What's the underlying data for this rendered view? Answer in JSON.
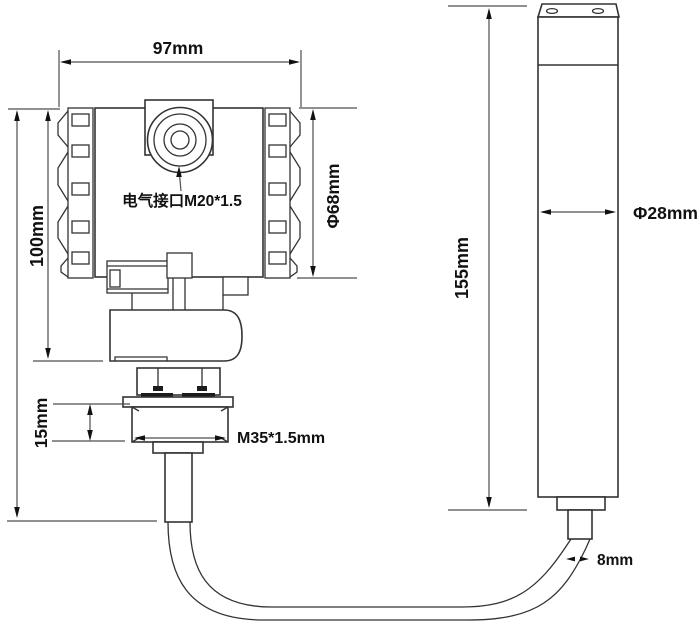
{
  "colors": {
    "background": "#ffffff",
    "shape_line": "#333333",
    "dimension_line": "#4d4d4d",
    "text": "#111111"
  },
  "transmitter_view": {
    "width_dim": "97mm",
    "height_dim": "100mm",
    "housing_dia_dim": "Φ68mm",
    "electrical_port_label": "电气接口M20*1.5",
    "thread_height_dim": "15mm",
    "thread_spec_label": "M35*1.5mm"
  },
  "probe_view": {
    "length_dim": "155mm",
    "dia_dim": "Φ28mm",
    "cable_dia_dim": "8mm"
  }
}
